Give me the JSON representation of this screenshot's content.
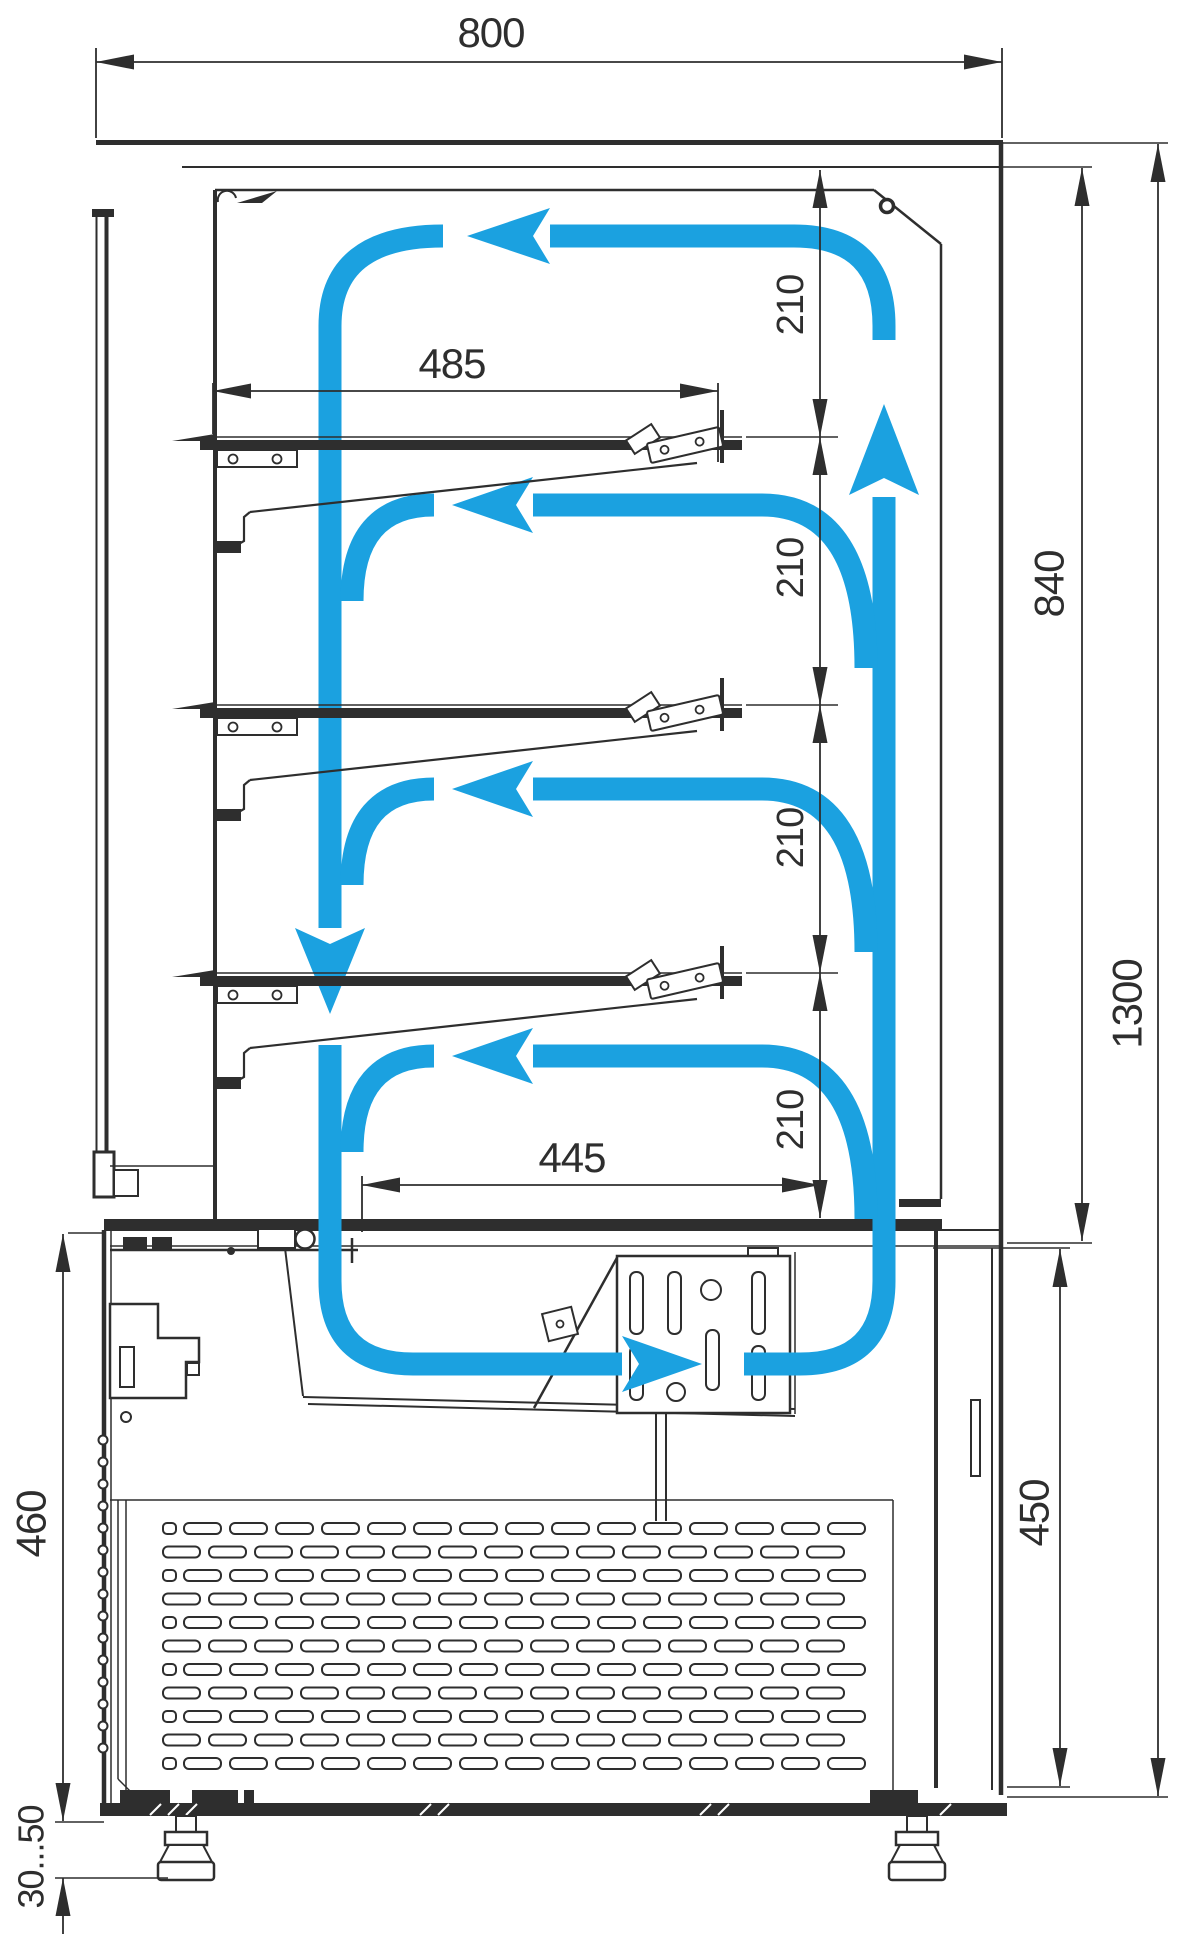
{
  "drawing": {
    "type": "technical-dimension-drawing",
    "subject": "refrigerated pastry display case - side section with airflow",
    "units_shown": "mm",
    "colors": {
      "line": "#2E2E2E",
      "airflow": "#1BA1E0",
      "background": "#FFFFFF"
    }
  },
  "labels": {
    "width_overall": "800",
    "width_shelf": "485",
    "width_lower_shelf": "445",
    "shelf_gap": "210",
    "height_display": "840",
    "height_overall": "1300",
    "height_base": "450",
    "height_condenser": "460",
    "leg_adjustment": "30...50"
  }
}
